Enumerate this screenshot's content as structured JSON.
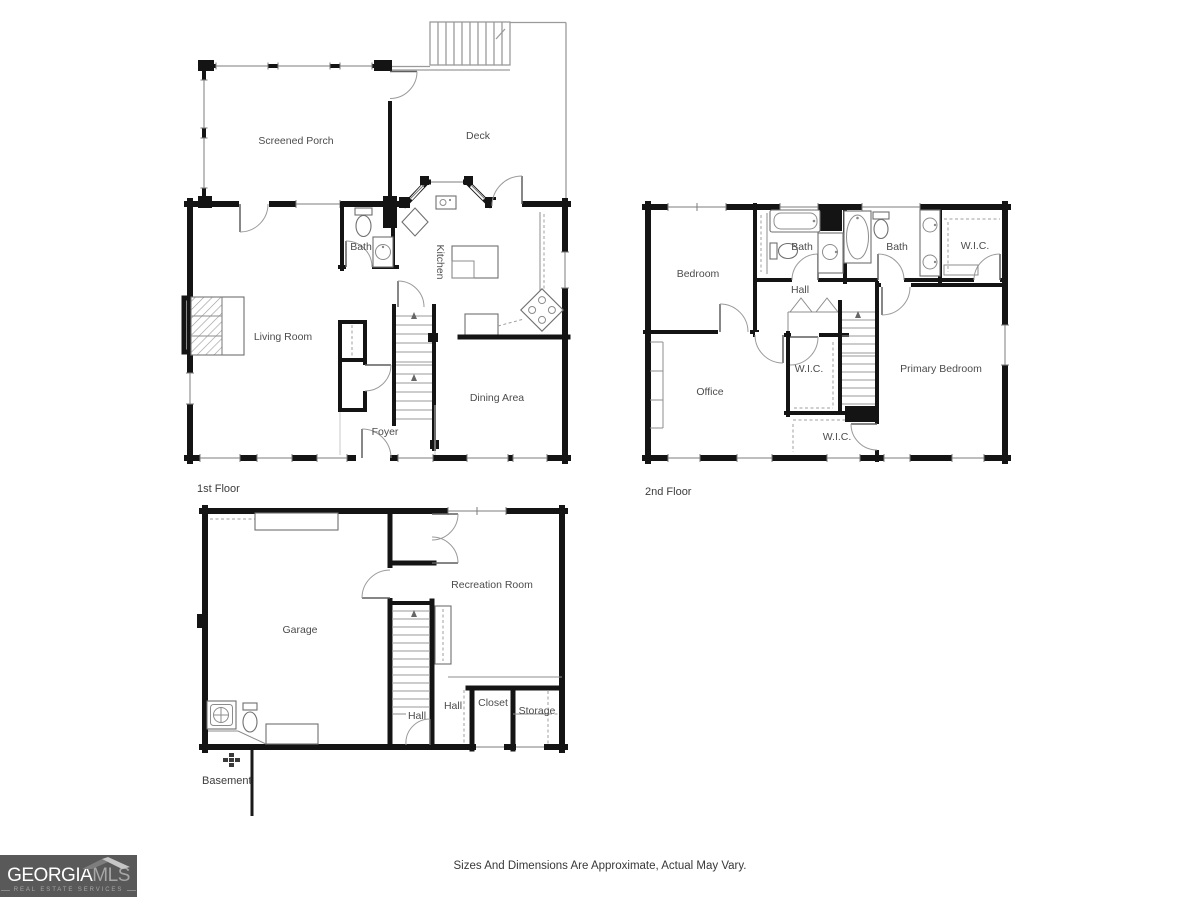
{
  "palette": {
    "wall": "#141414",
    "thin_line": "#8c8c8c",
    "label_text": "#4c4c4c",
    "logo_background": "#595959",
    "logo_primary_text": "#ffffff",
    "logo_secondary_text": "#a6a6a6"
  },
  "icons": {
    "roof": "roof-icon",
    "basement_marker": "plan-marker-icon",
    "stairs": "stairs-icon",
    "fireplace": "fireplace-icon"
  },
  "plans": {
    "first": {
      "floor_label": "1st Floor",
      "rooms": {
        "screened_porch": "Screened Porch",
        "deck": "Deck",
        "bath": "Bath",
        "kitchen": "Kitchen",
        "living_room": "Living Room",
        "dining_area": "Dining Area",
        "foyer": "Foyer"
      }
    },
    "second": {
      "floor_label": "2nd Floor",
      "rooms": {
        "bedroom": "Bedroom",
        "bath_left": "Bath",
        "bath_right": "Bath",
        "wic_top": "W.I.C.",
        "hall": "Hall",
        "office": "Office",
        "wic_middle": "W.I.C.",
        "wic_lower": "W.I.C.",
        "primary_bedroom": "Primary Bedroom"
      }
    },
    "basement": {
      "floor_label": "Basement",
      "rooms": {
        "garage": "Garage",
        "recreation_room": "Recreation Room",
        "hall_stairs": "Hall",
        "hall": "Hall",
        "closet": "Closet",
        "storage": "Storage"
      }
    }
  },
  "branding": {
    "name_primary": "GEORGIA",
    "name_secondary": "MLS",
    "tagline": "REAL ESTATE SERVICES"
  },
  "footer": {
    "disclaimer": "Sizes And Dimensions Are Approximate, Actual May Vary."
  }
}
